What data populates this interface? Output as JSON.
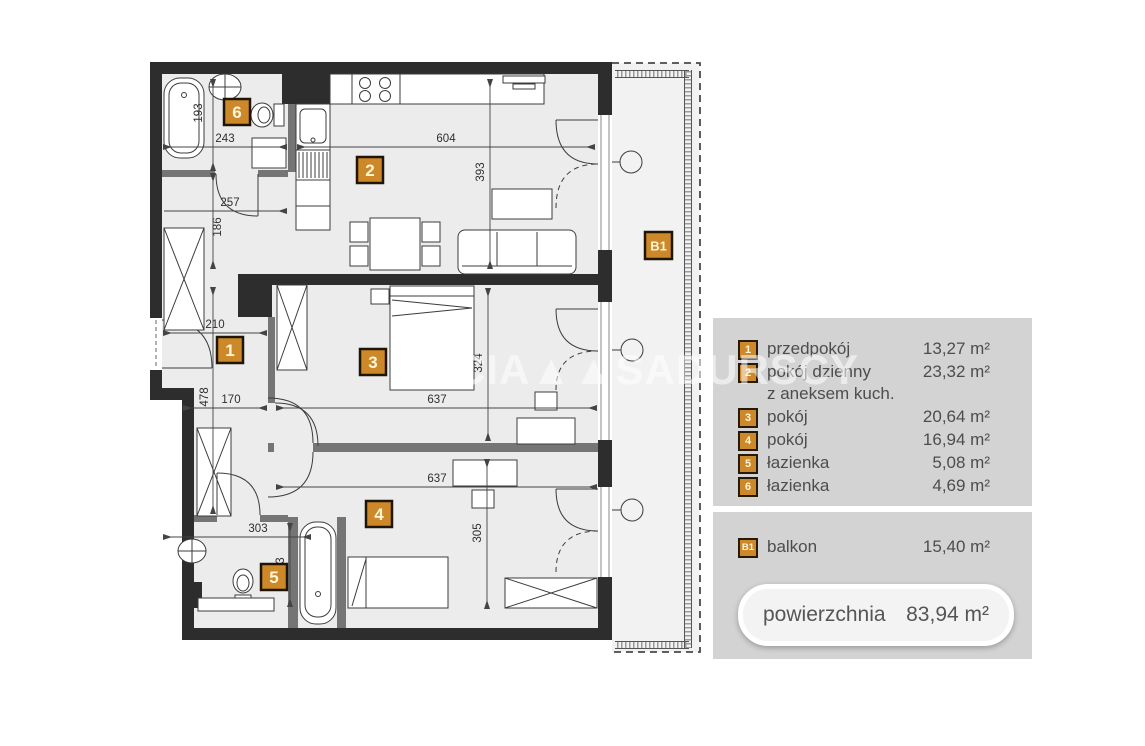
{
  "watermark": "CIA▲▲SADURSCY",
  "colors": {
    "wall": "#2d2d2d",
    "inner_wall": "#757575",
    "floor": "#ececec",
    "balcony_floor": "#f2f2f2",
    "badge_bg": "#cd8829",
    "badge_border": "#241a05",
    "legend_panel": "#d3d3d3",
    "legend_text": "#4d4d4d"
  },
  "plan": {
    "badges": [
      {
        "id": "1"
      },
      {
        "id": "2"
      },
      {
        "id": "3"
      },
      {
        "id": "4"
      },
      {
        "id": "5"
      },
      {
        "id": "6"
      },
      {
        "id": "B1"
      }
    ],
    "dims": [
      {
        "v": "604"
      },
      {
        "v": "393"
      },
      {
        "v": "243"
      },
      {
        "v": "193"
      },
      {
        "v": "257"
      },
      {
        "v": "186"
      },
      {
        "v": "210"
      },
      {
        "v": "478"
      },
      {
        "v": "170"
      },
      {
        "v": "637"
      },
      {
        "v": "324"
      },
      {
        "v": "637"
      },
      {
        "v": "305"
      },
      {
        "v": "303"
      },
      {
        "v": "173"
      }
    ]
  },
  "legend": {
    "rooms": [
      {
        "num": "1",
        "name": "przedpokój",
        "area": "13,27 m²"
      },
      {
        "num": "2",
        "name": "pokój dzienny",
        "name2": "z aneksem kuch.",
        "area": "23,32 m²"
      },
      {
        "num": "3",
        "name": "pokój",
        "area": "20,64 m²"
      },
      {
        "num": "4",
        "name": "pokój",
        "area": "16,94 m²"
      },
      {
        "num": "5",
        "name": "łazienka",
        "area": "5,08 m²"
      },
      {
        "num": "6",
        "name": "łazienka",
        "area": "4,69 m²"
      }
    ],
    "balcony": {
      "num": "B1",
      "name": "balkon",
      "area": "15,40 m²"
    },
    "total": {
      "label": "powierzchnia",
      "value": "83,94 m²"
    }
  }
}
